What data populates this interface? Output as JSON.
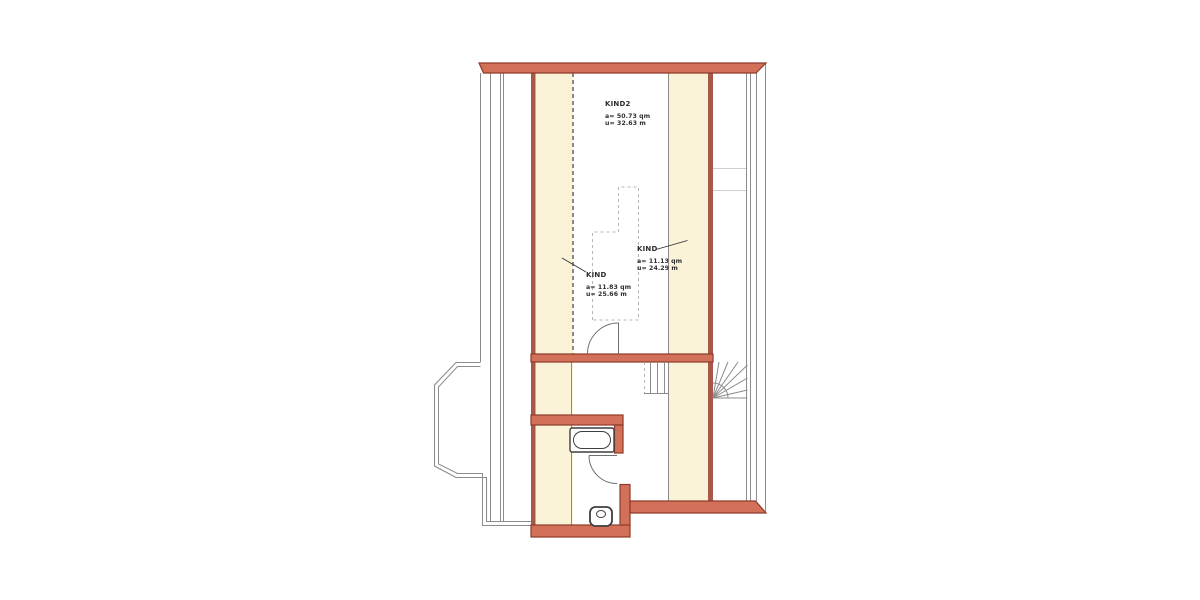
{
  "plan": {
    "title": "attic-floor-plan",
    "rooms": [
      {
        "id": "kind2",
        "name": "KIND2",
        "area": "a= 50.73 qm",
        "perimeter": "u= 32.63 m"
      },
      {
        "id": "kind-right",
        "name": "KIND",
        "area": "a= 11.13 qm",
        "perimeter": "u= 24.29 m"
      },
      {
        "id": "kind-left",
        "name": "KIND",
        "area": "a= 11.83 qm",
        "perimeter": "u= 25.66 m"
      }
    ],
    "fixtures": [
      "bathtub",
      "toilet",
      "door-swing-room",
      "door-swing-bath",
      "straight-stairs",
      "winder-stairs",
      "bay-window"
    ],
    "colors": {
      "background": "#ffffff",
      "wall_fill": "#d2705a",
      "wall_stroke": "#8e3b2a",
      "knee_fill": "#faf3d8",
      "knee_stroke": "#a85848",
      "line": "#8c8c8c",
      "line_light": "#cfcfcf",
      "dash_dark": "#5a5a5a",
      "dash_light": "#b5b5b5",
      "fixture": "#3f3f3f",
      "door": "#6f6f6f",
      "text": "#2e2e2e"
    }
  }
}
